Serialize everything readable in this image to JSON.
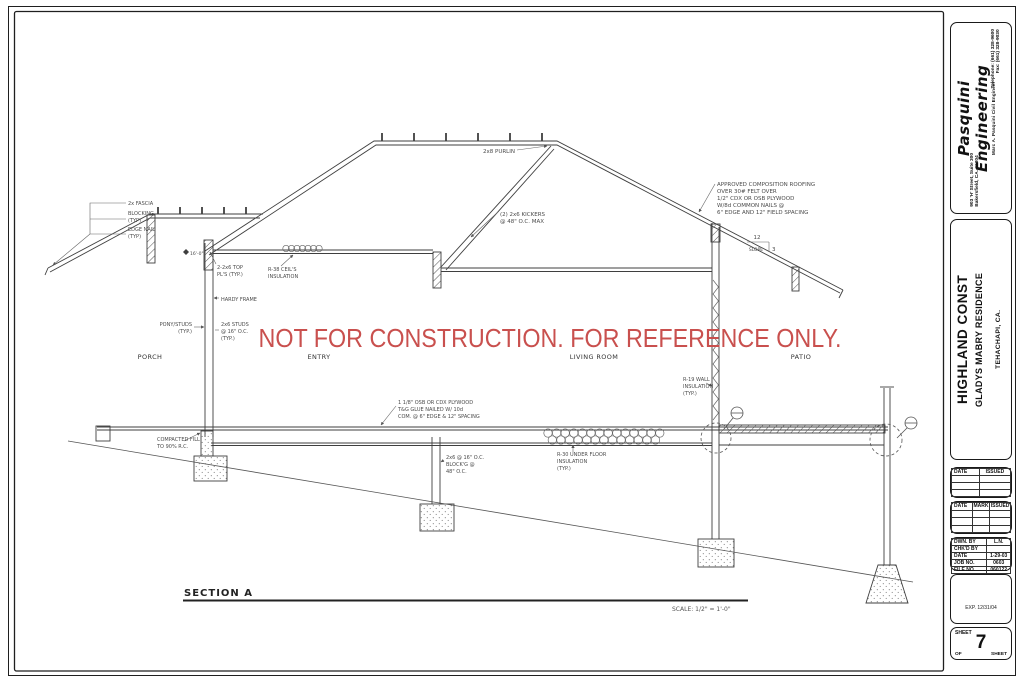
{
  "colors": {
    "watermark_red": "#c9504e",
    "line": "#454545"
  },
  "watermark": {
    "text": "NOT FOR CONSTRUCTION. FOR REFERENCE ONLY."
  },
  "rooms": {
    "porch": "PORCH",
    "entry": "ENTRY",
    "living": "LIVING ROOM",
    "patio": "PATIO"
  },
  "section_label": {
    "title": "SECTION A",
    "scale": "SCALE: 1/2\" = 1'-0\""
  },
  "ann": {
    "elev": "16'-0\"",
    "fascia": [
      "2x FASCIA",
      "BLOCKING",
      "(TYP)",
      "EDGE NAIL",
      "(TYP)"
    ],
    "top_plates": [
      "2-2x6 TOP",
      "PL'S (TYP.)"
    ],
    "r38": [
      "R-38 CEIL'S",
      "INSULATION"
    ],
    "hardy": "HARDY FRAME",
    "pony": [
      "PONY/STUDS",
      "(TYP.)"
    ],
    "studs": [
      "2x6 STUDS",
      "@ 16\" O.C.",
      "(TYP.)"
    ],
    "purlin": "2x8 PURLIN",
    "kickers": [
      "(2) 2x6 KICKERS",
      "@ 48\" O.C. MAX"
    ],
    "roofing": [
      "APPROVED COMPOSITION ROOFING",
      "OVER 30# FELT OVER",
      "1/2\" CDX OR OSB PLYWOOD",
      "W/8d COMMON NAILS @",
      "6\" EDGE AND 12\" FIELD SPACING"
    ],
    "slope": {
      "run": "12",
      "word": "SLOPE",
      "rise": "3"
    },
    "r19": [
      "R-19 WALL",
      "INSULATION",
      "(TYP.)"
    ],
    "subfloor": [
      "1 1/8\" OSB OR CDX PLYWOOD",
      "T&G GLUE NAILED W/ 10d",
      "COM. @ 6\" EDGE & 12\" SPACING"
    ],
    "r30": [
      "R-30 UNDER FLOOR",
      "INSULATION",
      "(TYP.)"
    ],
    "floor_framing": [
      "2x6 @ 16\" O.C.",
      "BLOCK'G @",
      "48\" O.C."
    ],
    "fill": [
      "COMPACTED FILL",
      "TO 90% R.C."
    ]
  },
  "titleblock": {
    "firm": {
      "name_line1": "Pasquini",
      "name_line2": "Engineering",
      "tagline": "Marc A. Pasquini   Civil Engineer",
      "address_line1": "903 'H' Street, Suite 300",
      "address_line2": "Bakersfield, CA. 93304",
      "phone": "Telephone: (661) 328-9600",
      "fax": "Fax: (661) 328-9030"
    },
    "project": {
      "client": "HIGHLAND CONST",
      "residence": "GLADYS MABRY RESIDENCE",
      "location": "TEHACHAPI, CA."
    },
    "revisions1": {
      "col_date": "DATE",
      "col_issued": "ISSUED"
    },
    "revisions2": {
      "col_date": "DATE",
      "col_mark": "MARK",
      "col_issued": "ISSUED"
    },
    "info": {
      "drawn_by_label": "DWN. BY",
      "drawn_by": "L.N.",
      "checked_by_label": "CHK'D BY",
      "checked_by": "",
      "date_label": "DATE",
      "date": "1-29-03",
      "job_no_label": "JOB NO.",
      "job_no": "0603",
      "file_no_label": "FILE NO.",
      "file_no": "060122"
    },
    "stamp": {
      "expiration": "EXP. 12/31/04"
    },
    "sheet": {
      "sheet_label": "SHEET",
      "number": "7",
      "of_label": "OF",
      "sheets_label": "SHEET"
    }
  }
}
